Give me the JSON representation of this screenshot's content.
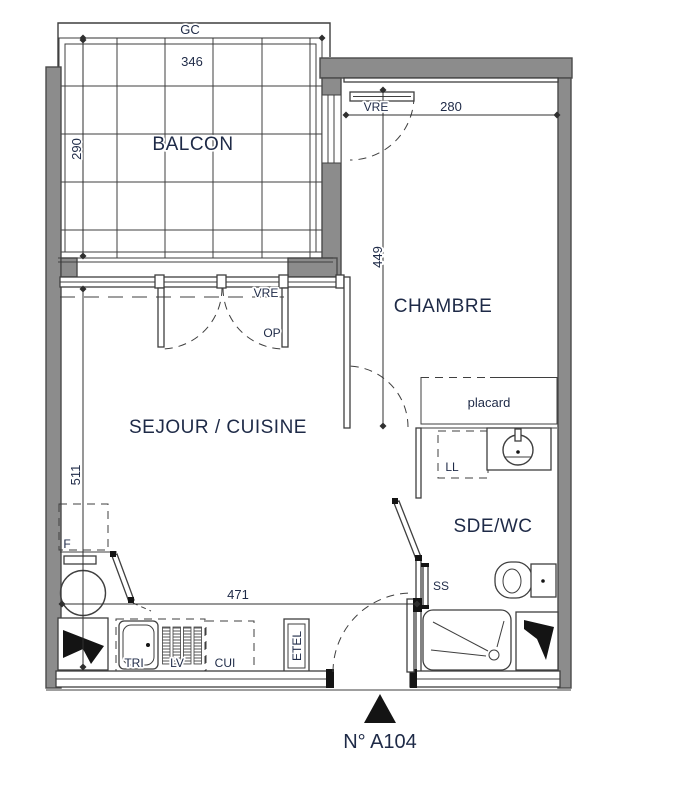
{
  "unit": {
    "number": "N° A104"
  },
  "rooms": {
    "balcony": {
      "label": "BALCON"
    },
    "living_kitchen": {
      "label": "SEJOUR / CUISINE"
    },
    "bedroom": {
      "label": "CHAMBRE"
    },
    "shower_wc": {
      "label": "SDE/WC"
    }
  },
  "openings": {
    "railing_label": "GC",
    "living_window_label": "VRE",
    "living_window_opening_label": "OP",
    "bedroom_window_label": "VRE"
  },
  "fixtures": {
    "closet_label": "placard",
    "washing_machine_label": "LL",
    "fridge_label": "F",
    "sink_label": "TRI",
    "dishwasher_label": "LV",
    "cooktop_label": "CUI",
    "electrical_panel_label": "ETEL",
    "towel_dryer_label": "SS"
  },
  "dimensions": {
    "balcony_width": "346",
    "balcony_depth": "290",
    "bedroom_width": "280",
    "bedroom_depth": "449",
    "living_depth": "511",
    "living_width": "471"
  },
  "colors": {
    "wall": "#8c8c8c",
    "text": "#1e2a47",
    "ink": "#141414"
  }
}
